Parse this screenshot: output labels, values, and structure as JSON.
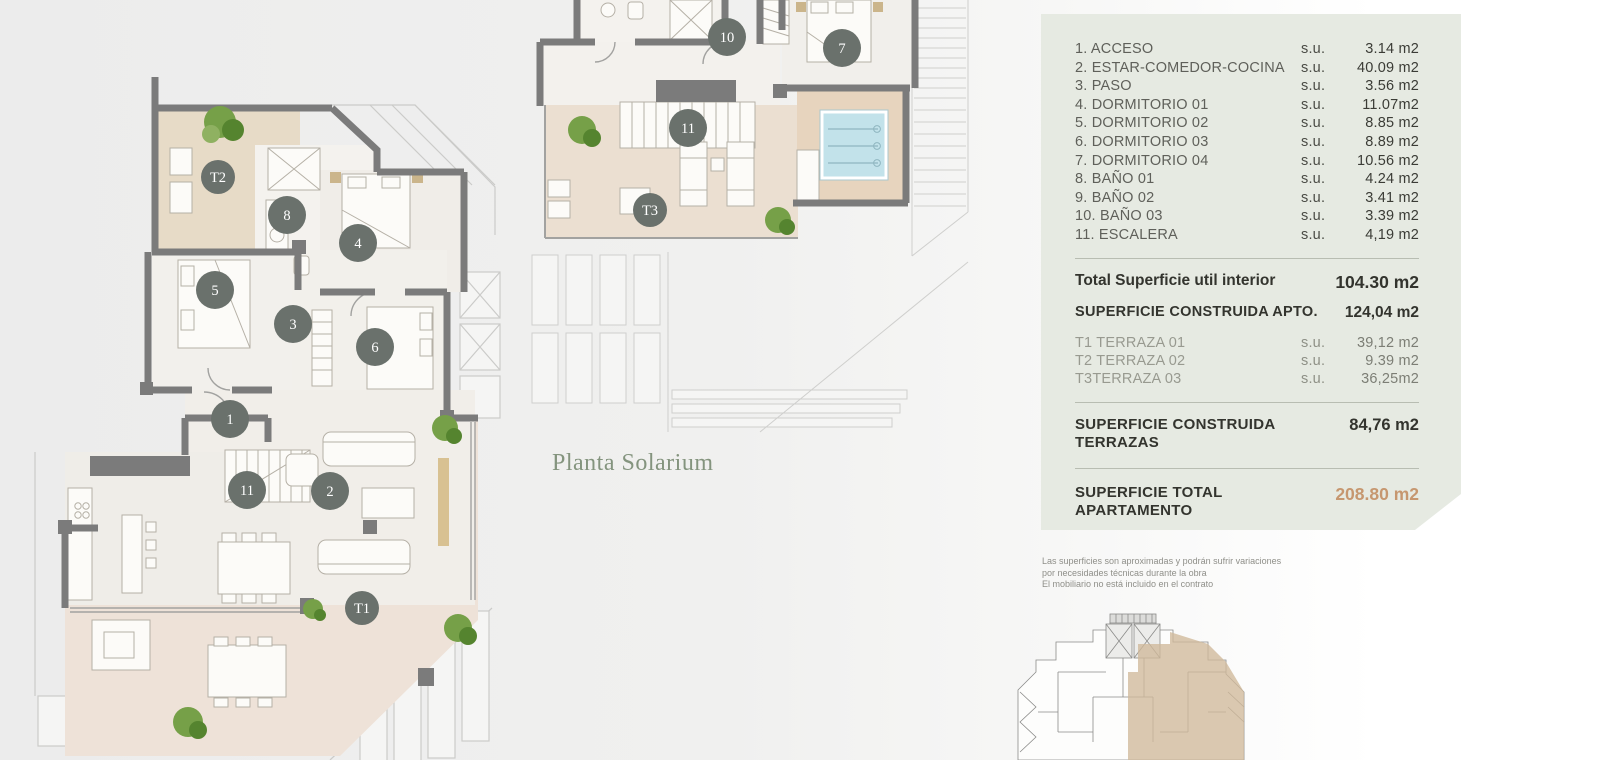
{
  "plans": {
    "left": {
      "markers": [
        {
          "label": "T2"
        },
        {
          "label": "8"
        },
        {
          "label": "4"
        },
        {
          "label": "5"
        },
        {
          "label": "3"
        },
        {
          "label": "6"
        },
        {
          "label": "1"
        },
        {
          "label": "11"
        },
        {
          "label": "2"
        },
        {
          "label": "T1"
        }
      ]
    },
    "solarium": {
      "title": "Planta Solarium",
      "markers": [
        {
          "label": "10"
        },
        {
          "label": "7"
        },
        {
          "label": "11"
        },
        {
          "label": "T3"
        }
      ]
    }
  },
  "legend": {
    "rooms": [
      {
        "name": "1. ACCESO",
        "su": "s.u.",
        "area": "3.14 m2"
      },
      {
        "name": "2. ESTAR-COMEDOR-COCINA",
        "su": "s.u.",
        "area": "40.09 m2"
      },
      {
        "name": "3. PASO",
        "su": "s.u.",
        "area": "3.56 m2"
      },
      {
        "name": "4. DORMITORIO 01",
        "su": "s.u.",
        "area": "11.07m2"
      },
      {
        "name": "5. DORMITORIO 02",
        "su": "s.u.",
        "area": "8.85 m2"
      },
      {
        "name": "6. DORMITORIO 03",
        "su": "s.u.",
        "area": "8.89 m2"
      },
      {
        "name": "7. DORMITORIO 04",
        "su": "s.u.",
        "area": "10.56 m2"
      },
      {
        "name": "8. BAÑO 01",
        "su": "s.u.",
        "area": "4.24 m2"
      },
      {
        "name": "9. BAÑO 02",
        "su": "s.u.",
        "area": "3.41 m2"
      },
      {
        "name": "10. BAÑO 03",
        "su": "s.u.",
        "area": "3.39 m2"
      },
      {
        "name": "11. ESCALERA",
        "su": "s.u.",
        "area": "4,19 m2"
      }
    ],
    "total_util": {
      "label": "Total Superficie util interior",
      "value": "104.30 m2"
    },
    "construida_apto": {
      "label": "SUPERFICIE CONSTRUIDA APTO.",
      "value": "124,04 m2"
    },
    "terraces": [
      {
        "name": "T1 TERRAZA 01",
        "su": "s.u.",
        "area": "39,12 m2"
      },
      {
        "name": "T2 TERRAZA 02",
        "su": "s.u.",
        "area": "9.39 m2"
      },
      {
        "name": "T3TERRAZA 03",
        "su": "s.u.",
        "area": "36,25m2"
      }
    ],
    "construida_terrazas": {
      "label_line1": "SUPERFICIE CONSTRUIDA",
      "label_line2": "TERRAZAS",
      "value": "84,76 m2"
    },
    "total_apartamento": {
      "label_line1": "SUPERFICIE TOTAL",
      "label_line2": "APARTAMENTO",
      "value": "208.80 m2"
    }
  },
  "disclaimer": {
    "line1": "Las superficies son aproximadas y podrán sufrir variaciones",
    "line2": "por necesidades técnicas durante la obra",
    "line3": "El mobiliario no está incluido en el contrato"
  },
  "colors": {
    "accent_orange": "#c6976f",
    "panel_bg": "#e6eae2",
    "marker": "#6a716c",
    "terrace_beige": "#ebdfd1",
    "pool_blue": "#c2e2ea"
  }
}
